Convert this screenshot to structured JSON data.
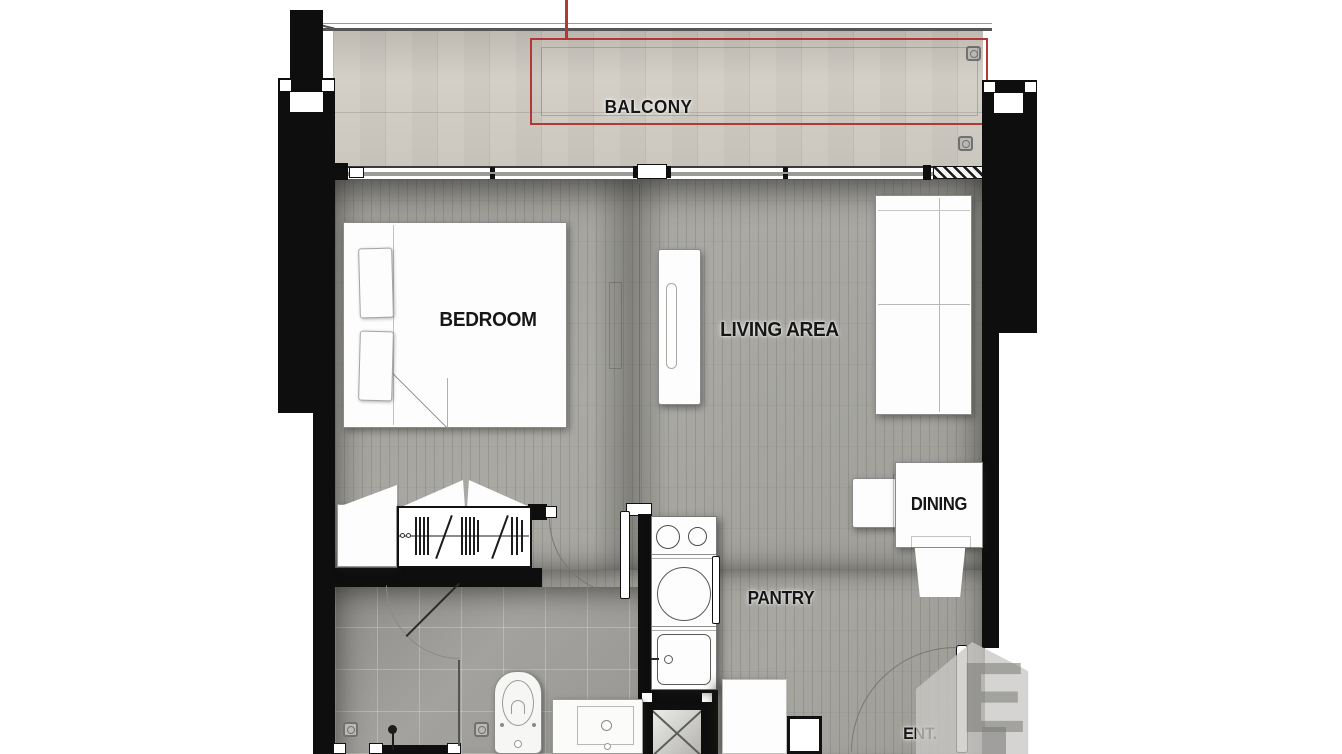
{
  "plan": {
    "type": "apartment-floor-plan",
    "rooms": {
      "balcony": {
        "label": "BALCONY"
      },
      "bedroom": {
        "label": "BEDROOM"
      },
      "living": {
        "label": "LIVING AREA"
      },
      "dining": {
        "label": "DINING"
      },
      "pantry": {
        "label": "PANTRY"
      },
      "entrance": {
        "label": "ENT."
      }
    },
    "colors": {
      "wall": "#0e0e0e",
      "annotation_red": "#b23835",
      "balcony_tile": "#d7d3cb",
      "wood_floor": "#a5a4a0",
      "bath_floor": "#9c9b97",
      "furniture_fill": "#fdfdfd",
      "label_text": "#161616"
    },
    "watermark": {
      "letter": "E"
    }
  }
}
